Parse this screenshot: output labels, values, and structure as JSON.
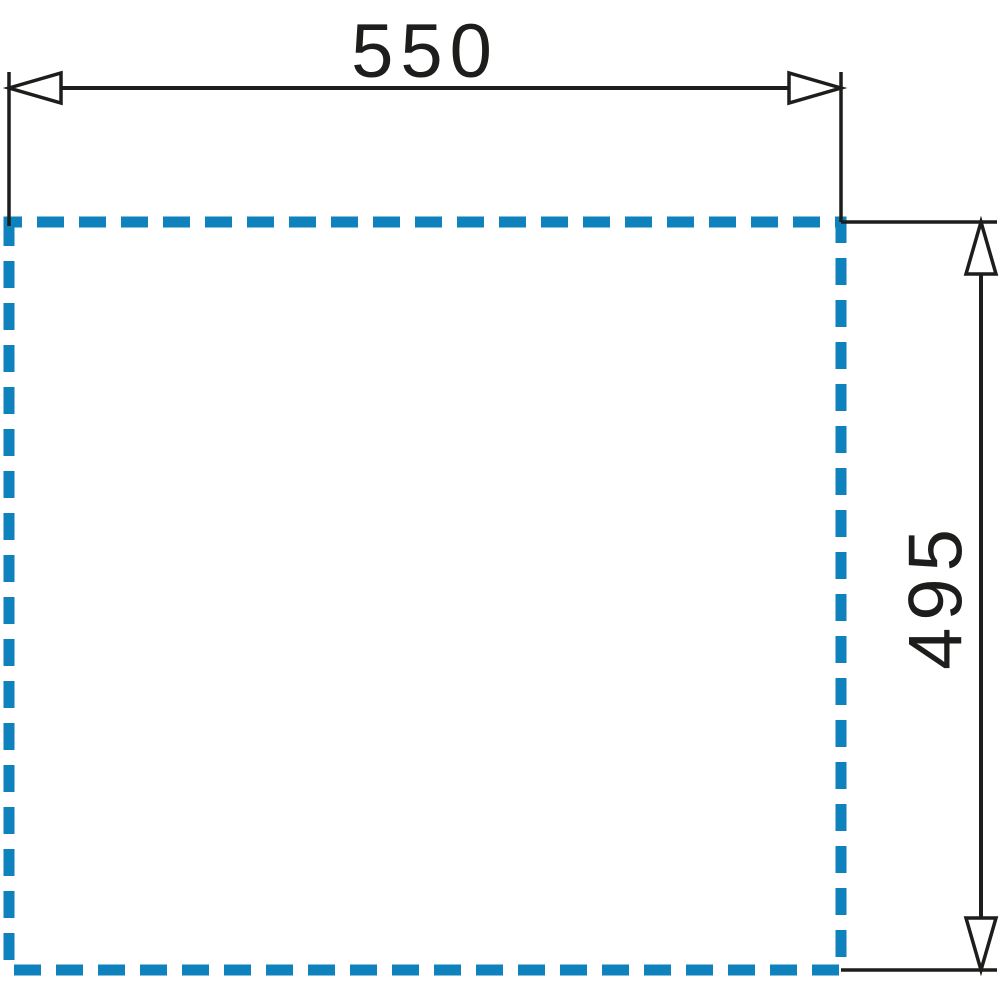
{
  "diagram": {
    "type": "technical-dimension-drawing",
    "width_label": "550",
    "height_label": "495"
  },
  "colors": {
    "outline_blue": "#0f81bd",
    "line_black": "#1d1d1b",
    "background": "#ffffff"
  }
}
